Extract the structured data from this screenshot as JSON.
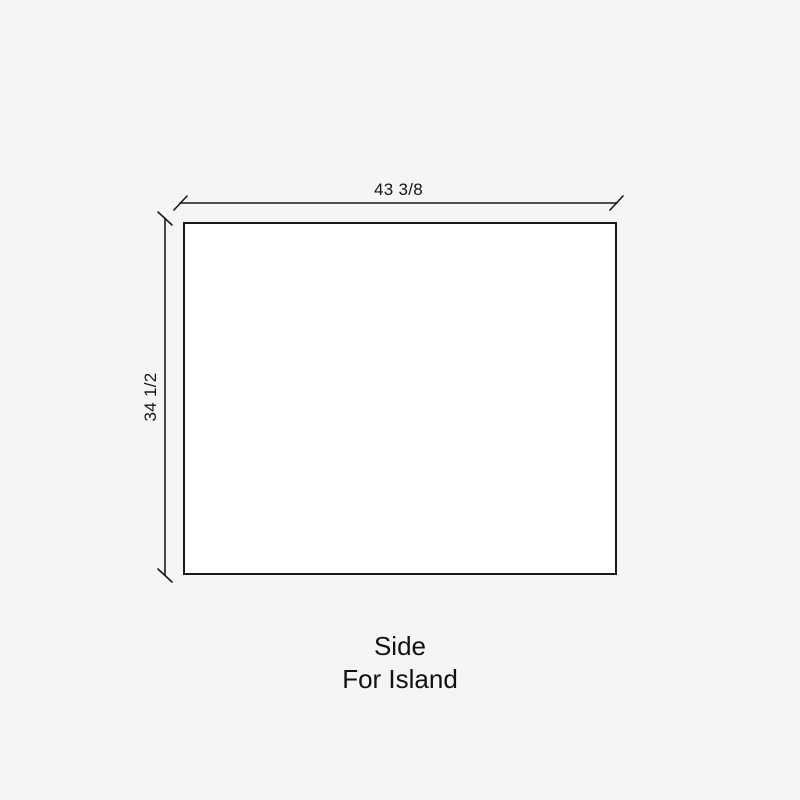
{
  "background_color": "#f5f5f5",
  "drawing": {
    "type": "dimensioned-rectangle",
    "shape_fill": "#ffffff",
    "line_color": "#1a1a1a",
    "width_dimension": "43 3/8",
    "height_dimension": "34 1/2"
  },
  "caption": {
    "title": "Side",
    "subtitle": "For Island"
  }
}
